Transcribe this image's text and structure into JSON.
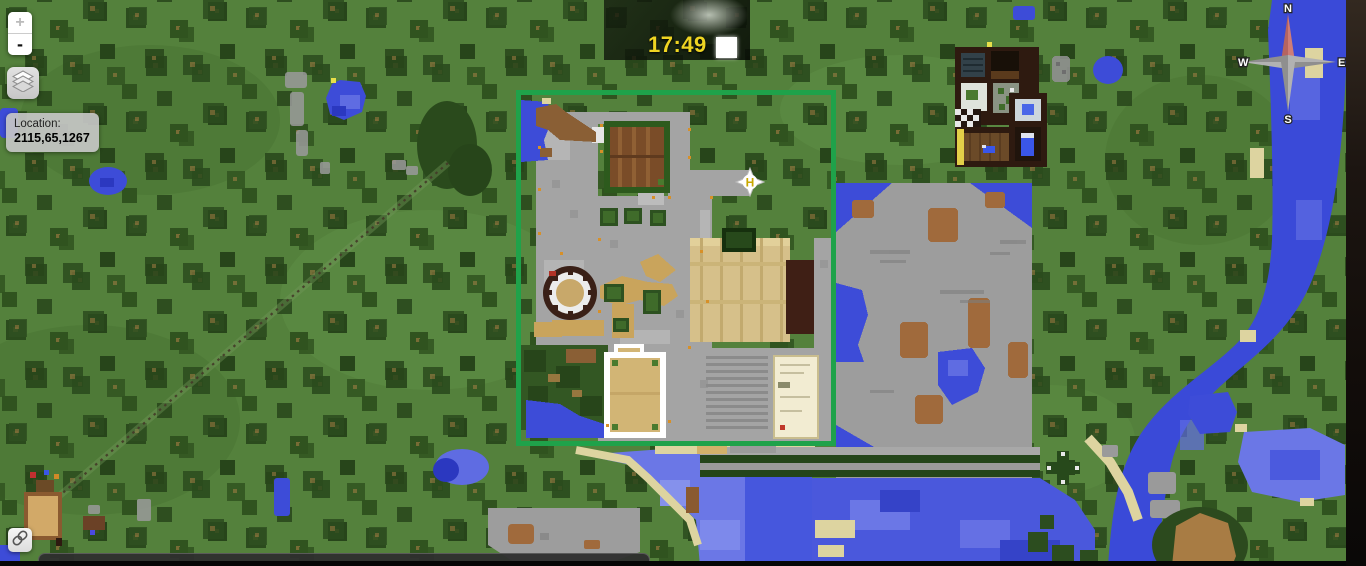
{
  "map_controls": {
    "zoom_in_label": "+",
    "zoom_out_label": "-",
    "layers_icon": "layers-icon",
    "link_icon": "chain-link-icon"
  },
  "location_box": {
    "label": "Location:",
    "value": "2115,65,1267"
  },
  "clock": {
    "time": "17:49",
    "day_icon": "sun-square-icon",
    "time_color": "#eed422"
  },
  "compass": {
    "n": "N",
    "e": "E",
    "s": "S",
    "w": "W"
  },
  "highlight": {
    "color": "#1fa24a"
  },
  "marker": {
    "label": "H",
    "icon": "compass-star-marker-icon"
  }
}
